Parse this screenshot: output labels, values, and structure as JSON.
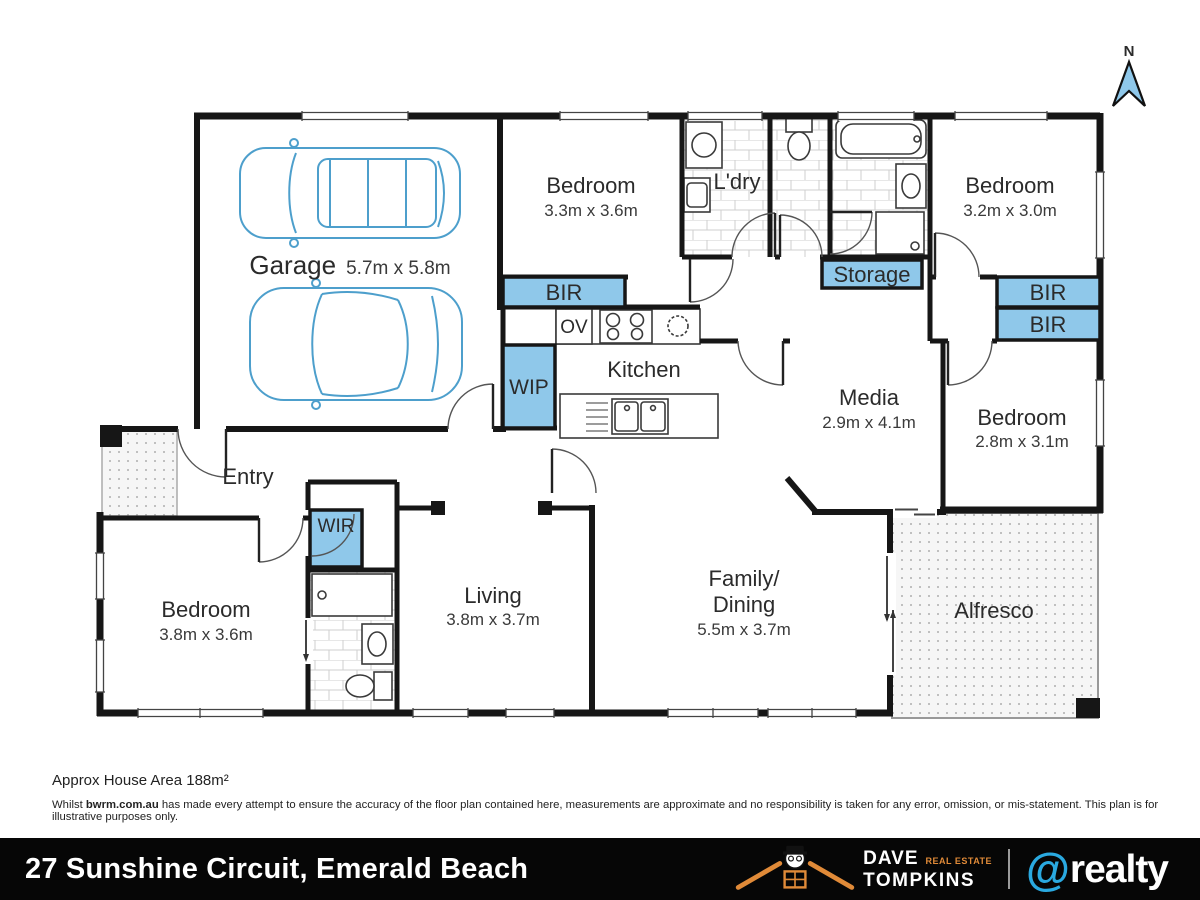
{
  "north_indicator": {
    "label": "N"
  },
  "rooms": {
    "garage": {
      "name": "Garage",
      "dims": "5.7m x 5.8m"
    },
    "bedroom2": {
      "name": "Bedroom",
      "dims": "3.3m x 3.6m"
    },
    "laundry": {
      "name": "L'dry"
    },
    "bedroom3": {
      "name": "Bedroom",
      "dims": "3.2m x 3.0m"
    },
    "kitchen": {
      "name": "Kitchen"
    },
    "media": {
      "name": "Media",
      "dims": "2.9m x 4.1m"
    },
    "bedroom4": {
      "name": "Bedroom",
      "dims": "2.8m x 3.1m"
    },
    "entry": {
      "name": "Entry"
    },
    "master_bedroom": {
      "name": "Bedroom",
      "dims": "3.8m x 3.6m"
    },
    "living": {
      "name": "Living",
      "dims": "3.8m x 3.7m"
    },
    "family_dining": {
      "name_line1": "Family/",
      "name_line2": "Dining",
      "dims": "5.5m x 3.7m"
    },
    "alfresco": {
      "name": "Alfresco"
    }
  },
  "storage_labels": {
    "bir_left": "BIR",
    "bir_right_top": "BIR",
    "bir_right_bottom": "BIR",
    "wip": "WIP",
    "wir": "WIR",
    "storage": "Storage",
    "oven": "OV"
  },
  "footer": {
    "area": "Approx House Area 188m²",
    "disclaimer_prefix": "Whilst ",
    "disclaimer_site": "bwrm.com.au",
    "disclaimer_rest": " has made every attempt to ensure the accuracy of the floor plan contained here, measurements are approximate and no responsibility is taken for any error, omission, or mis-statement. This plan is for illustrative purposes only."
  },
  "banner": {
    "address": "27 Sunshine Circuit, Emerald Beach",
    "agency": {
      "name_top": "DAVE",
      "name_bottom": "TOMPKINS",
      "tagline": "REAL ESTATE"
    },
    "brand": {
      "at": "@",
      "name": "realty"
    }
  },
  "colors": {
    "closet_blue": "#8FC8EA",
    "car_blue": "#4D9FCC",
    "wall": "#161616",
    "brand_blue": "#2AA9E0",
    "agency_orange": "#E08A38",
    "banner_black": "#060606"
  }
}
